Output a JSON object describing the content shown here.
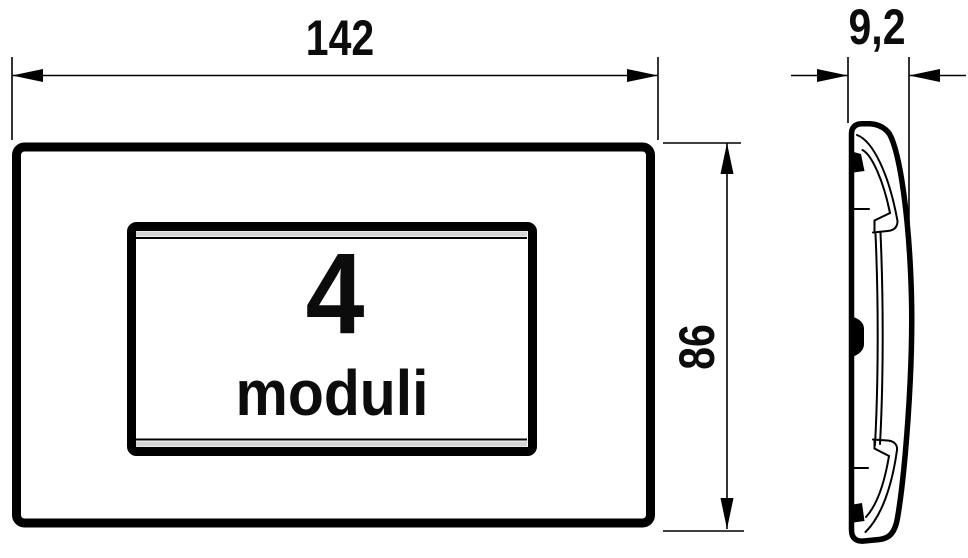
{
  "drawing": {
    "type": "technical-dimension-drawing",
    "background_color": "#ffffff",
    "line_color": "#000000",
    "accent_gray": "#d4d4d4",
    "front_view": {
      "module_count": "4",
      "module_label": "moduli",
      "width_dimension": "142",
      "height_dimension": "86"
    },
    "side_view": {
      "depth_dimension": "9,2"
    }
  }
}
